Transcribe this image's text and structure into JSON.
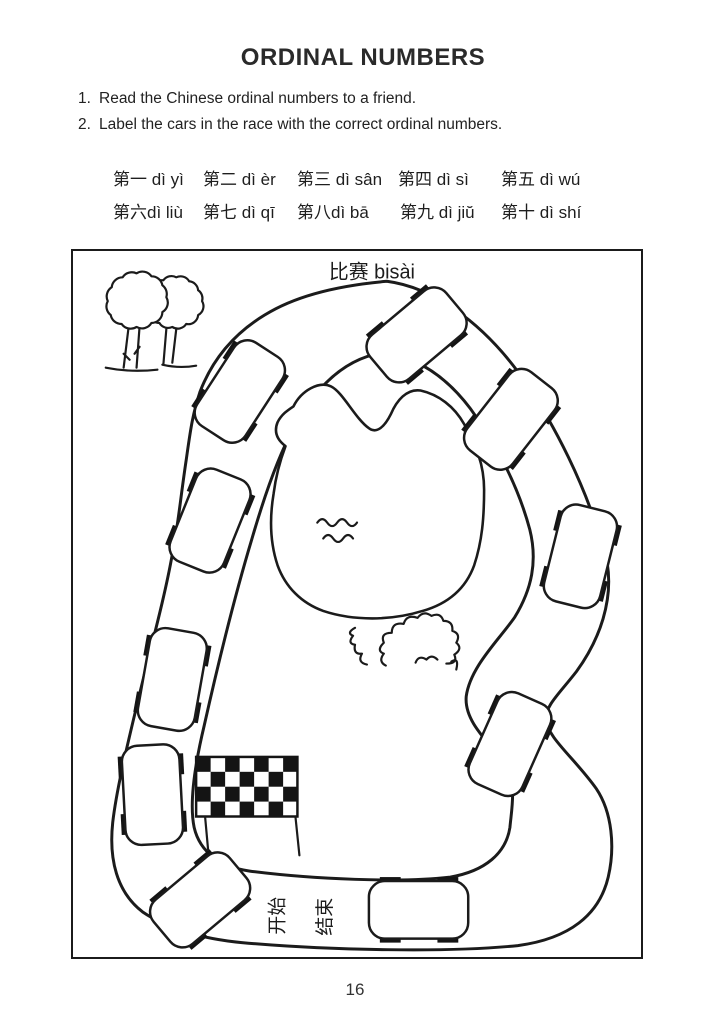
{
  "page": {
    "title": "ORDINAL NUMBERS",
    "page_number": "16"
  },
  "instructions": [
    {
      "num": "1.",
      "text": "Read the Chinese ordinal numbers to a friend."
    },
    {
      "num": "2.",
      "text": "Label the cars in the race with the correct ordinal numbers."
    }
  ],
  "ordinals": {
    "row1": [
      "第一 dì yì",
      "第二 dì èr",
      "第三 dì sân",
      "第四 dì sì",
      "第五 dì wú"
    ],
    "row2": [
      "第六dì liù",
      "第七 dì qī",
      "第八dì bā",
      "第九 dì jiŭ",
      "第十 dì shí"
    ]
  },
  "illustration": {
    "caption": "比赛 bisài",
    "start_label": "开始",
    "finish_label": "结束",
    "car_count": 10
  },
  "colors": {
    "ink": "#1b1b1b",
    "paper": "#ffffff"
  }
}
